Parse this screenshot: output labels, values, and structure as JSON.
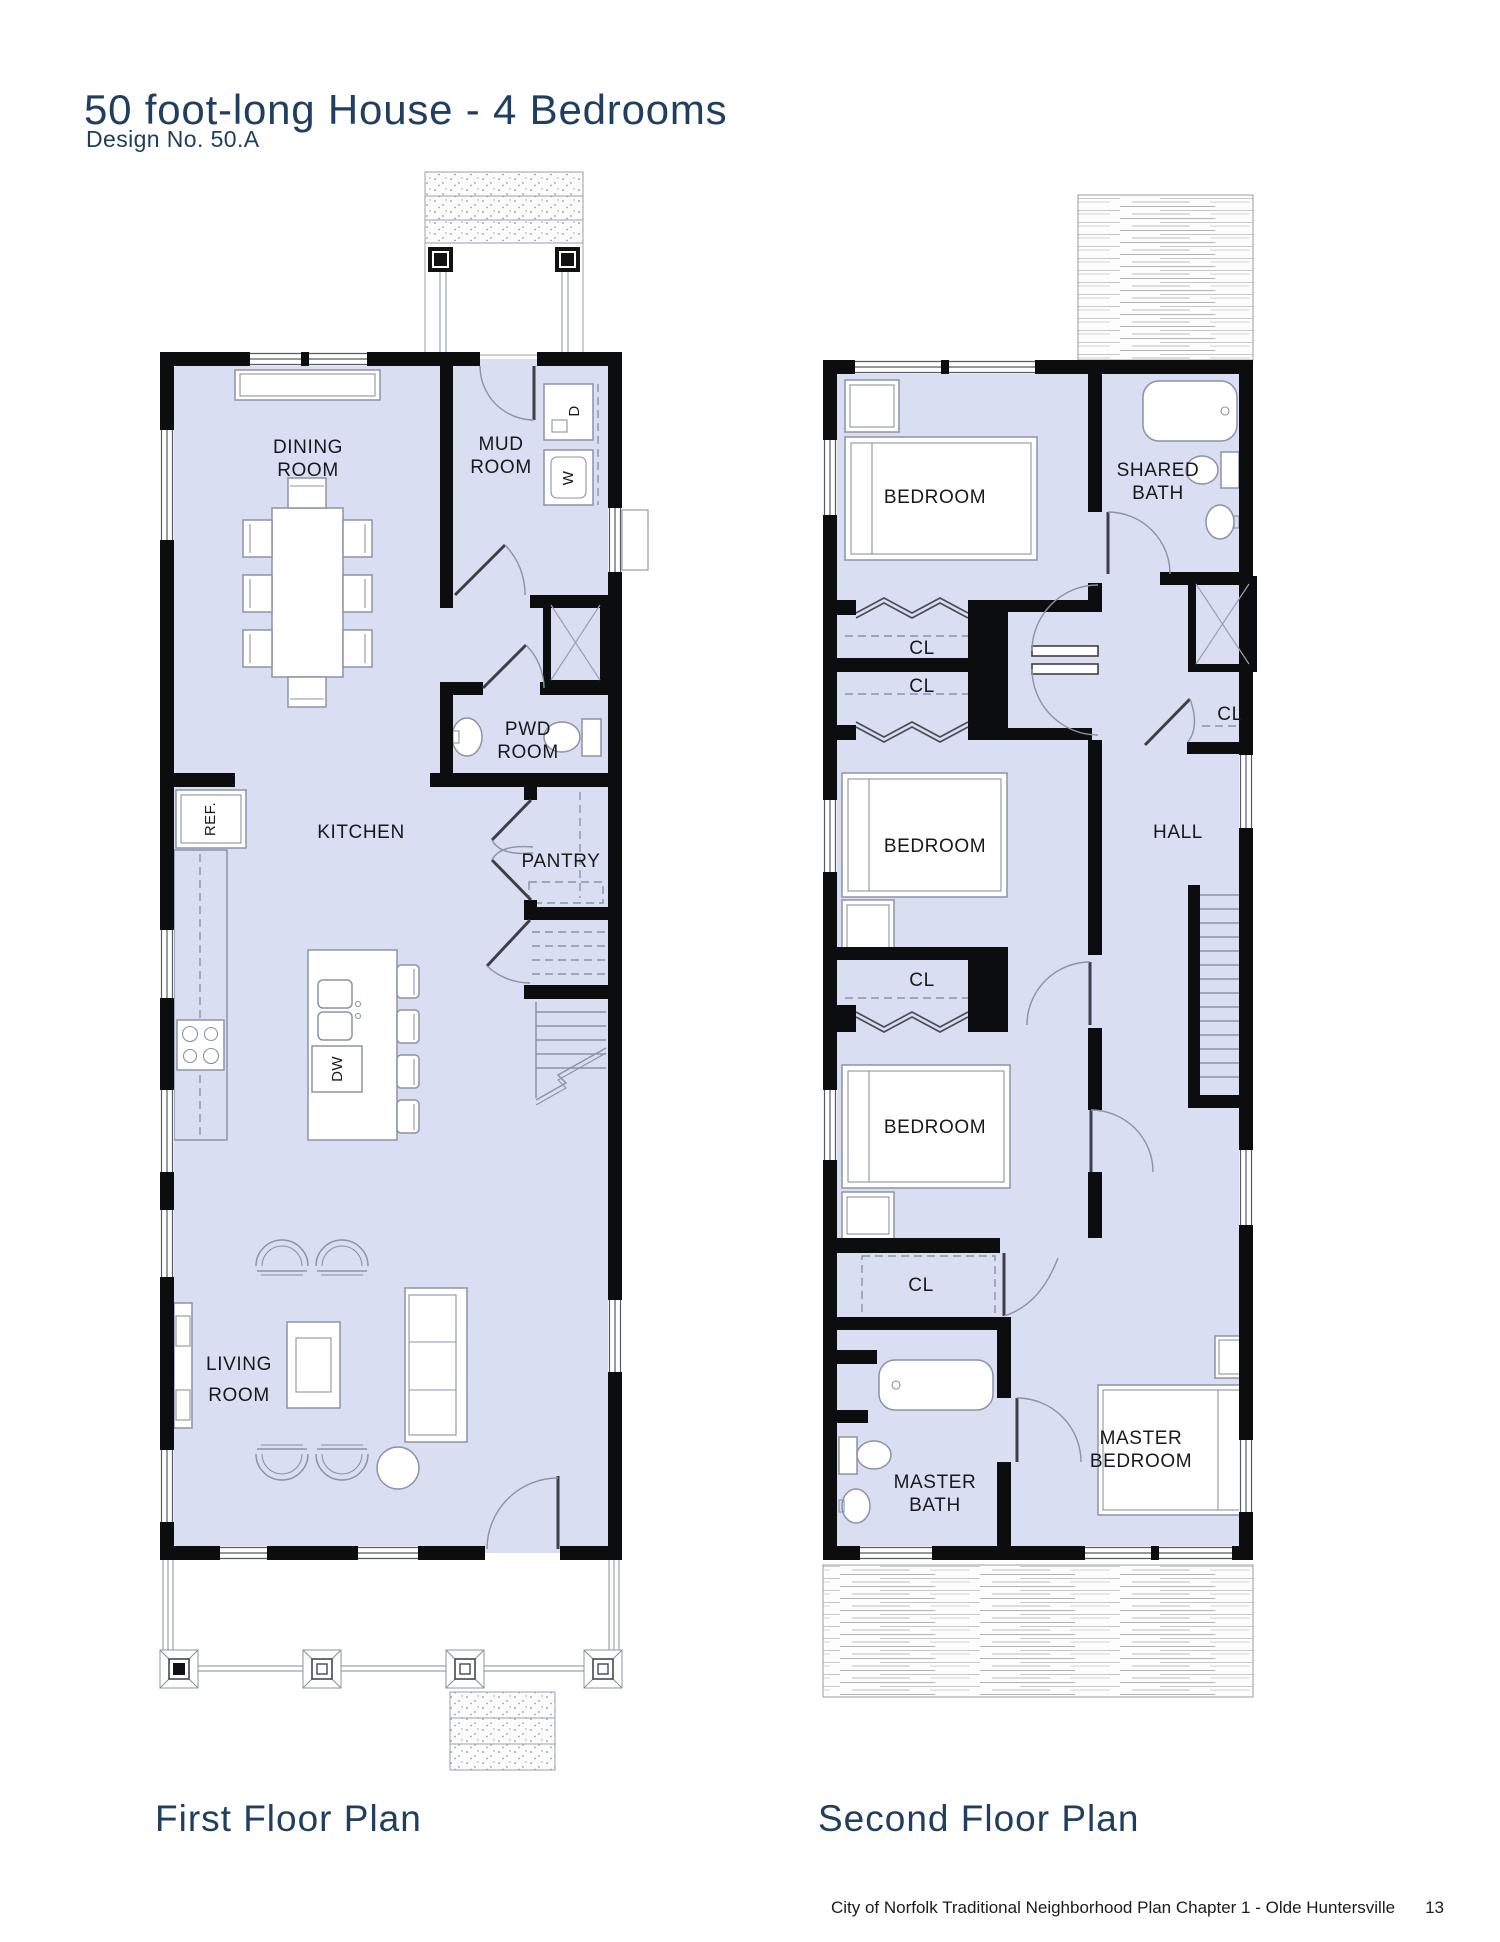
{
  "page": {
    "title": "50 foot-long House - 4 Bedrooms",
    "subtitle": "Design No. 50.A",
    "footer_text": "City of Norfolk Traditional Neighborhood Plan Chapter 1 - Olde Huntersville",
    "footer_page": "13"
  },
  "colors": {
    "accent_navy": "#1f3e60",
    "room_fill": "#dadef2",
    "wall": "#0c0d0e",
    "furniture_line": "#8b93a4"
  },
  "first_floor": {
    "caption": "First Floor Plan",
    "labels": {
      "dining_1": "DINING",
      "dining_2": "ROOM",
      "mud_1": "MUD",
      "mud_2": "ROOM",
      "pwd_1": "PWD",
      "pwd_2": "ROOM",
      "kitchen": "KITCHEN",
      "pantry": "PANTRY",
      "living_1": "LIVING",
      "living_2": "ROOM",
      "fridge": "REF.",
      "dishwasher": "DW",
      "washer": "W",
      "dryer": "D"
    }
  },
  "second_floor": {
    "caption": "Second Floor Plan",
    "labels": {
      "bedroom_top": "BEDROOM",
      "bedroom_mid": "BEDROOM",
      "bedroom_low": "BEDROOM",
      "shared_1": "SHARED",
      "shared_2": "BATH",
      "hall": "HALL",
      "cl_bed1": "CL",
      "cl_bed2": "CL",
      "cl_hall": "CL",
      "cl_bed3": "CL",
      "cl_master": "CL",
      "master_bed_1": "MASTER",
      "master_bed_2": "BEDROOM",
      "master_bath_1": "MASTER",
      "master_bath_2": "BATH"
    }
  }
}
